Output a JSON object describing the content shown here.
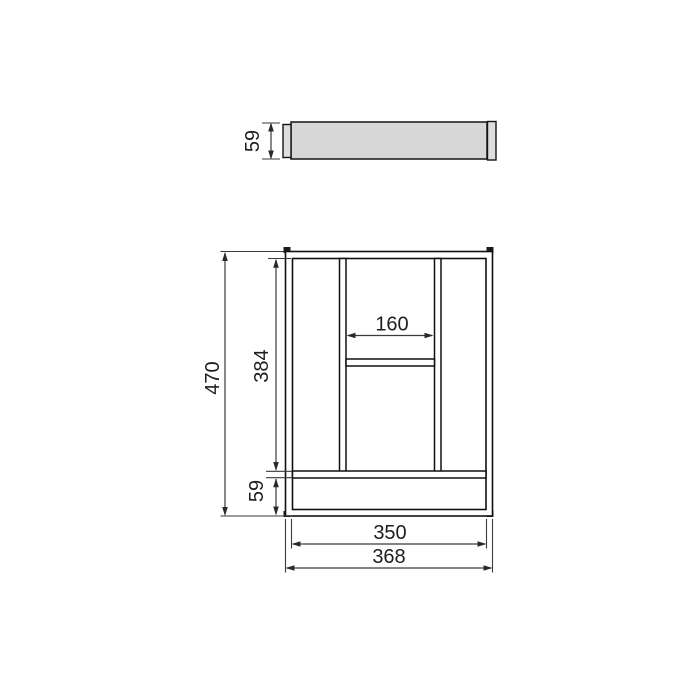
{
  "drawing": {
    "type": "technical-dimension-drawing",
    "subject": "cutlery tray insert",
    "views": {
      "side_view": {
        "thickness_dim": "59"
      },
      "plan_view": {
        "overall_height_dim": "470",
        "inner_height_dim": "384",
        "center_compartment_width_dim": "160",
        "front_compartment_depth_dim": "59",
        "inner_width_dim": "350",
        "overall_width_dim": "368"
      }
    },
    "colors": {
      "outline": "#101010",
      "dimension_lines": "#3a3a3a",
      "tray_fill": "#d7d7d7",
      "background": "#ffffff"
    }
  }
}
